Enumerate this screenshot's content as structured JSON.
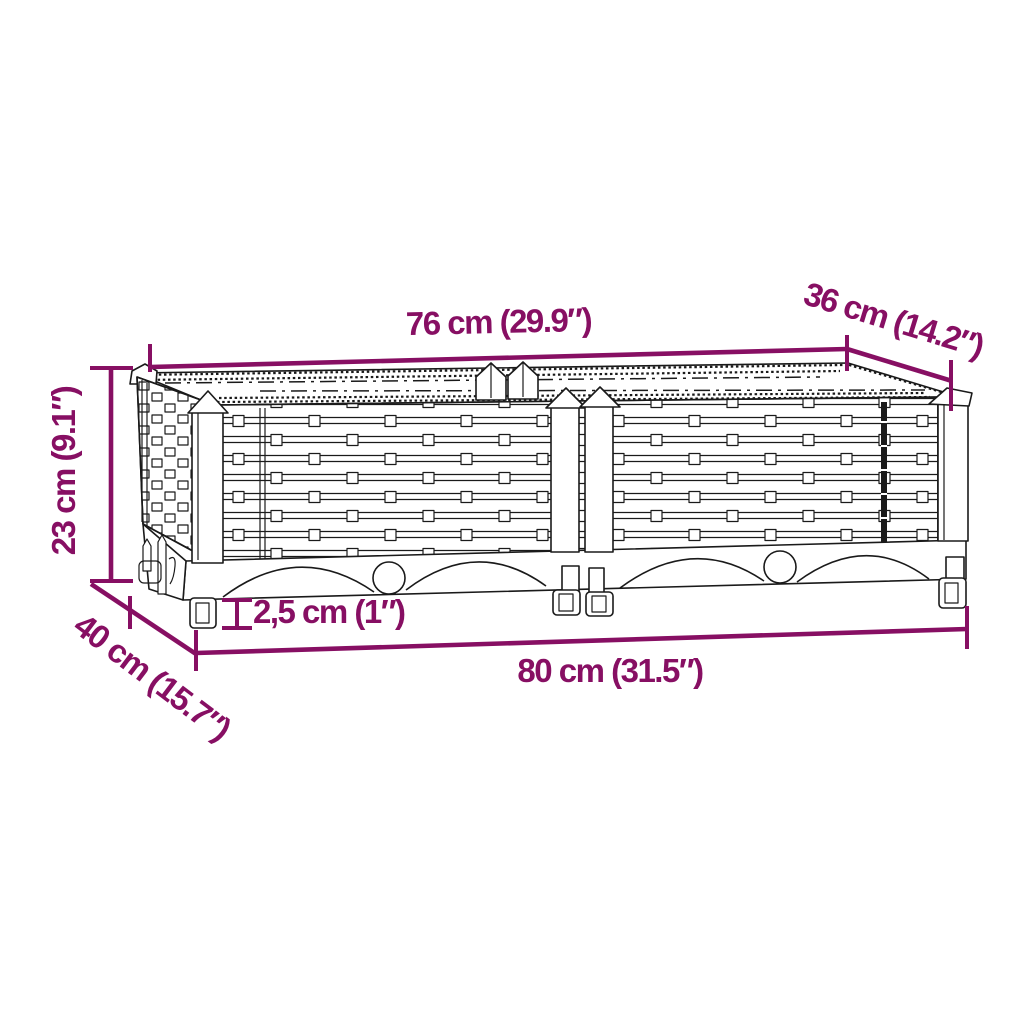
{
  "figure": {
    "type": "product dimension diagram",
    "subject": "rattan-look raised garden bed line drawing"
  },
  "dimension_labels": {
    "top_width": "76 cm (29.9″)",
    "top_depth": "36 cm (14.2″)",
    "height": "23 cm (9.1″)",
    "base_depth": "40 cm (15.7″)",
    "foot_height": "2,5 cm (1″)",
    "base_width": "80 cm (31.5″)"
  },
  "colors": {
    "accent": "#870f63",
    "line": "#1a1a1a",
    "background": "#ffffff"
  }
}
